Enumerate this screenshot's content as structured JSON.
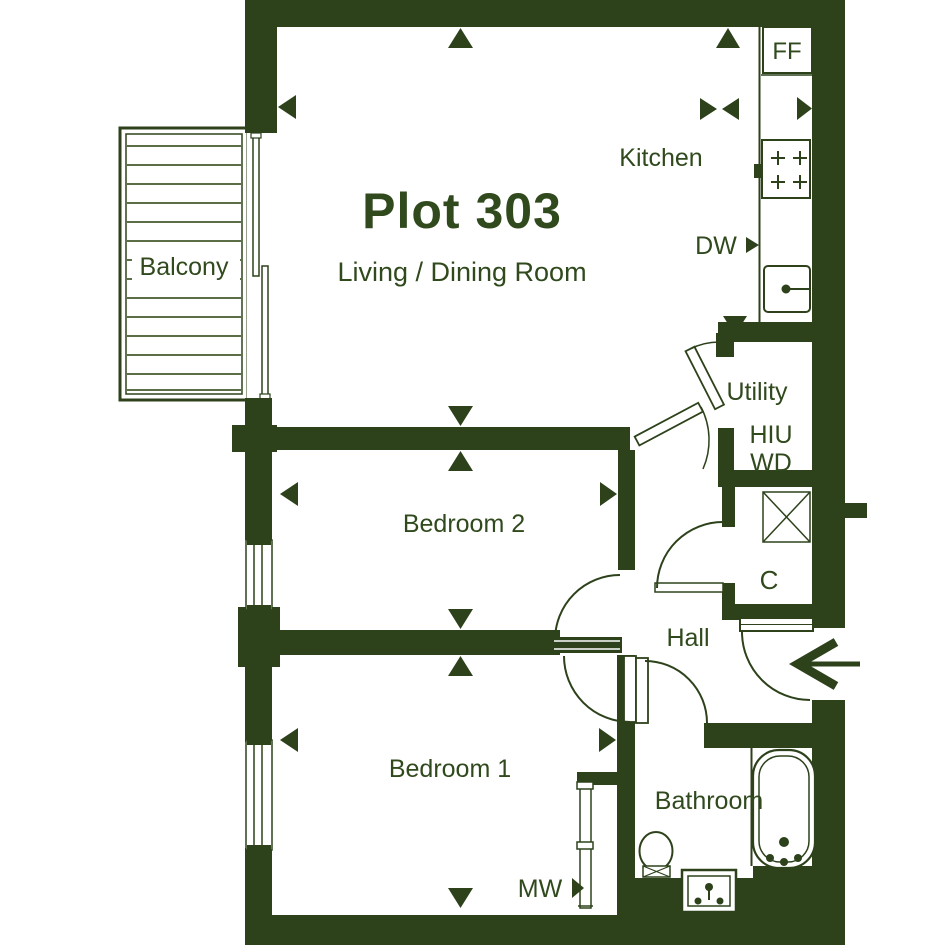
{
  "plan": {
    "title": "Plot 303",
    "rooms": {
      "living": "Living / Dining Room",
      "kitchen": "Kitchen",
      "balcony": "Balcony",
      "bedroom2": "Bedroom 2",
      "bedroom1": "Bedroom 1",
      "hall": "Hall",
      "bathroom": "Bathroom",
      "utility": "Utility",
      "cupboard": "C"
    },
    "labels": {
      "fridge_freezer": "FF",
      "dishwasher": "DW",
      "heat_interface_unit": "HIU",
      "washer_dryer": "WD",
      "microwave": "MW"
    },
    "colors": {
      "wall": "#2d421b",
      "text": "#30491d",
      "deck_line": "#44592c",
      "background": "#ffffff"
    }
  }
}
